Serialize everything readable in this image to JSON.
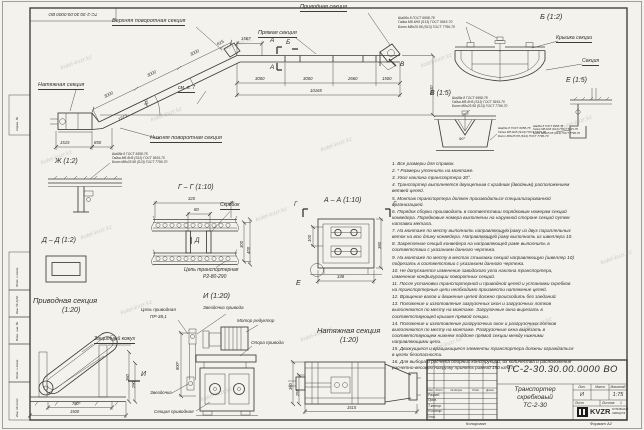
{
  "frame": {
    "corner_stamp": "ТС-2-30.30.00.0000 ВО",
    "left_labels": [
      "Справ. №",
      "Подп. и дата",
      "Инв. № дубл.",
      "Взам. инв. №",
      "Подп. и дата",
      "Инв. № подл."
    ]
  },
  "wm": "kotel-kvzr.kz",
  "mv": {
    "l_upper": "Верхняя поворотная секция",
    "l_straight": "Прямая секция",
    "l_drive": "Приводная секция",
    "l_tension": "Натяжная секция",
    "l_lower": "Нижняя поворотная секция",
    "l_note": "см. п. 7",
    "m_a": "А",
    "m_b": "Б",
    "m_v": "В",
    "d3000": "3000",
    "d615": "615",
    "d1567": "1567",
    "d2660": "2660",
    "d1500": "1500",
    "d_total": "10165",
    "d_h": "5630",
    "d1515": "1515",
    "d850": "850",
    "d1213": "1213",
    "d_ang": "30°"
  },
  "spec": [
    "Шайба 8 ГОСТ 6958-78",
    "Гайка М8-6Н5 (S13) ГОСТ 5915-70",
    "Болт М8х25.58 (S13) ГОСТ 7796-70"
  ],
  "db": {
    "t": "Б (1:2)",
    "cover": "Крышка секции",
    "sec": "Секция"
  },
  "dv": {
    "t": "В (1:5)",
    "ang": "90°"
  },
  "de": {
    "t": "Е (1:5)"
  },
  "dzh": {
    "t": "Ж (1:2)"
  },
  "dg": {
    "t": "Г – Г (1:10)",
    "scr": "Скребок",
    "ch1": "Цепь транспортерная",
    "ch2": "Р2-80-290",
    "d320": "320",
    "d80": "80",
    "d300": "300",
    "d400": "400",
    "m": "Д"
  },
  "dd": {
    "t": "Д – Д (1:2)"
  },
  "da": {
    "t": "А – А (1:10)",
    "mg": "Г",
    "me": "Е",
    "d348": "348",
    "d360": "360",
    "d100": "100"
  },
  "dr": {
    "t1": "Приводная секция",
    "t2": "(1:20)",
    "casing": "Защитный кожух",
    "m": "И",
    "d780": "780*",
    "d1500": "1500",
    "d360": "360",
    "d290": "290"
  },
  "di": {
    "t": "И (1:20)",
    "ch1": "Цепь приводная",
    "ch2": "ПР-38,1",
    "spr_d": "Звездочка привода",
    "motor": "Мотор редуктор",
    "sup": "Опора привода",
    "spr": "Звездочка",
    "sec": "Секция приводная",
    "d800": "800*"
  },
  "dt": {
    "t1": "Натяжная секция",
    "t2": "(1:20)",
    "d1515": "1515",
    "d360": "360",
    "d255": "255"
  },
  "notes": {
    "items": [
      "1. Все размеры для справок.",
      "2. * Размеры уточнить на монтаже.",
      "3. Угол наклона транспортера 30°.",
      "4. Транспортер выполняется двухцепным с крайним (двойным) расположением ветвей цепей.",
      "5. Монтаж транспортера должен производиться специализированной организацией.",
      "6. Порядок сборки производить в соответствии порядковым номерам секций конвейера. Порядковые номера выполнены на наружной стороне секций путем наплавки метала.",
      "7. На монтаже по месту выполнить направляющую раму из двух параллельных веток на всю длину конвейера. Направляющую раму выполнить из швеллера 10.",
      "8. Закрепление секций конвейера на направляющей раме выполнить в соответствии с указанием данного чертежа.",
      "9. На монтаже по месту в местах стыковки секций направляющую (швеллер 10) подрезать в соответствии с указанием данного чертежа.",
      "10. Не допускается изменение заводского угла наклона транспортера, изменение конфигурации поворотных секций.",
      "11. После установки транспортерной и приводной цепей и установки скребков на транспортерные цепи необходимо произвести натяжение цепей.",
      "12. Вращение валов и движение цепей должно происходить без заеданий.",
      "13. Положение и изготовление загрузочных окон и загрузочных лотков выполняются по месту на монтаже. Загрузочные окна вырезать в соответствующей крышке прямой секции.",
      "14. Положение и изготовление разгрузочных окон и разгрузочных лотков выполняются по месту на монтаже. Разгрузочные окна вырезать в соответствующем нижнем поддоне прямой секции между нижними направляющими цепи.",
      "15. Движущиеся и вращающиеся элементы транспортера должны ограждаться в целях безопасности.",
      "16. Для выбора и расчета опорных конструкций, их количества и расположения расчетно-весовую нагрузку принять равной 150 кг/м п."
    ]
  },
  "tb": {
    "doc": "ТС-2-30.30.00.0000  ВО",
    "n1": "Транспортер",
    "n2": "скребковый",
    "n3": "ТС-2-30",
    "lit_h": "Лит.",
    "mass_h": "Масса",
    "scale_h": "Масштаб",
    "lit": "И",
    "scale": "1:75",
    "sheet": "Лист",
    "sheets": "Листов",
    "sheets_n": "1",
    "r": [
      "Разраб.",
      "Пров.",
      "Т.контр.",
      "Н.контр.",
      "Утв."
    ],
    "c": [
      "Изм.",
      "Лист",
      "№ докум.",
      "Подп.",
      "Дата"
    ],
    "logo": "KVZR",
    "ls1": "КОТЕЛЬНЫЙ",
    "ls2": "ЗАВОД РФ",
    "copy": "Копировал",
    "fmt": "Формат А2"
  }
}
